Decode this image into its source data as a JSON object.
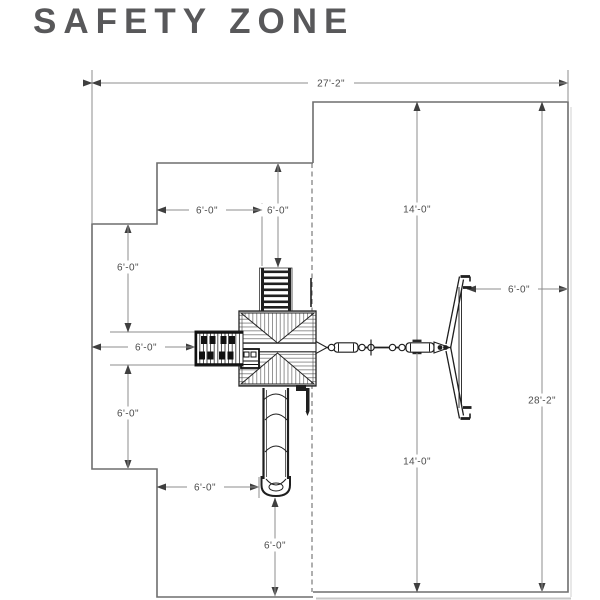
{
  "title": "SAFETY ZONE",
  "diagram": {
    "type": "playset-safety-zone-plan",
    "dimensions": {
      "overall_width": "27'-2\"",
      "right_zone_height": "28'-2\"",
      "swing_beam_to_top": "14'-0\"",
      "swing_beam_to_bottom": "14'-0\"",
      "swing_end_clearance": "6'-0\"",
      "climber_top_clearance": "6'-0\"",
      "tower_top_left_clearance": "6'-0\"",
      "left_upper_clearance": "6'-0\"",
      "monkey_bar_left_clearance": "6'-0\"",
      "left_lower_clearance": "6'-0\"",
      "slide_side_clearance": "6'-0\"",
      "slide_bottom_clearance": "6'-0\""
    },
    "colors": {
      "outline": "#6e6e6e",
      "dimension_line": "#8c8c8c",
      "dimension_text": "#4c4c4c",
      "playset_ink": "#1f1f1f",
      "title_text": "#58585a",
      "shadow": "#c6c6c6"
    }
  }
}
